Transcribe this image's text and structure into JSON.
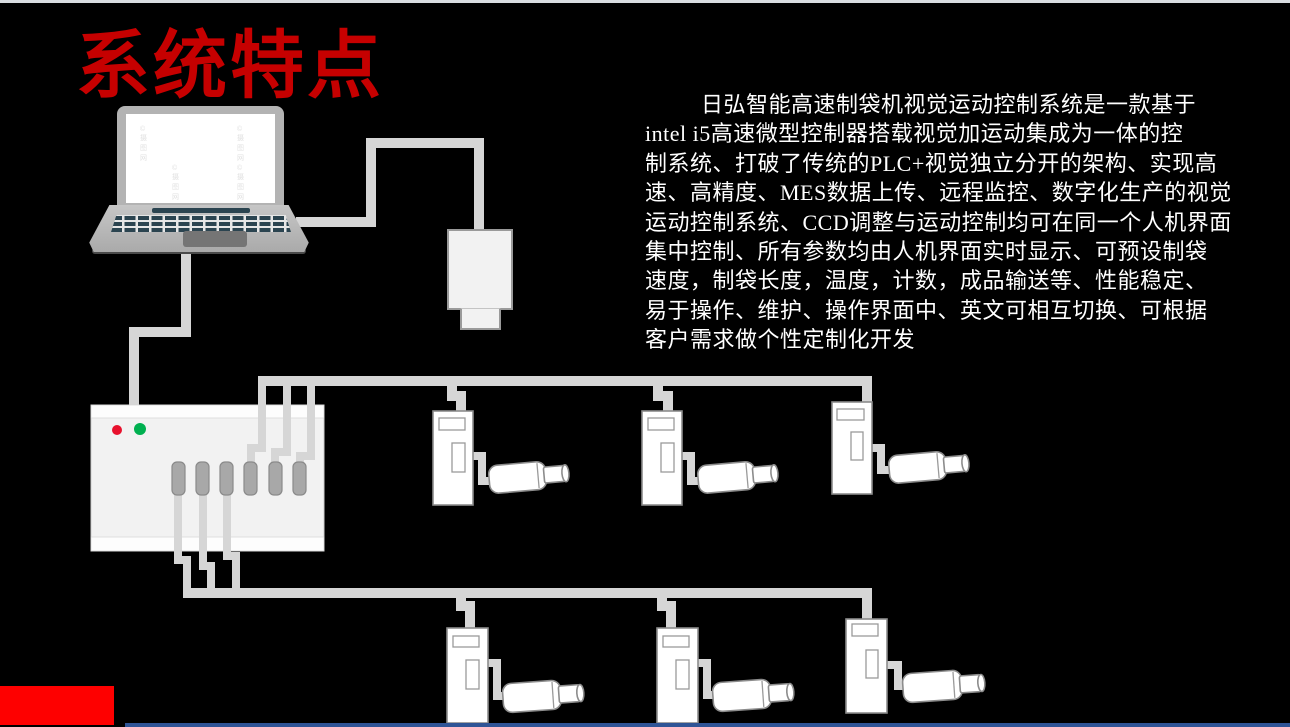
{
  "slide": {
    "title": "系统特点",
    "watermark": "© 摄图网",
    "description_lines": [
      "日弘智能高速制袋机视觉运动控制系统是一款基于",
      "intel i5高速微型控制器搭载视觉加运动集成为一体的控",
      "制系统、打破了传统的PLC+视觉独立分开的架构、实现高",
      "速、高精度、MES数据上传、远程监控、数字化生产的视觉",
      "运动控制系统、CCD调整与运动控制均可在同一个人机界面",
      "集中控制、所有参数均由人机界面实时显示、可预设制袋",
      "速度，制袋长度，温度，计数，成品输送等、性能稳定、",
      "易于操作、维护、操作界面中、英文可相互切换、可根据",
      "客户需求做个性定制化开发"
    ]
  },
  "colors": {
    "background": "#000000",
    "top_strip": "#d9dde1",
    "title_red": "#c60000",
    "accent_red": "#fe0000",
    "footer_blue": "#2f5496",
    "cable_gray": "#d6d6d6",
    "device_fill": "#f2f2f2",
    "device_border": "#8c8c8c",
    "keyboard_dark": "#2b4450",
    "led_red": "#e8112d",
    "led_green": "#00b050"
  }
}
